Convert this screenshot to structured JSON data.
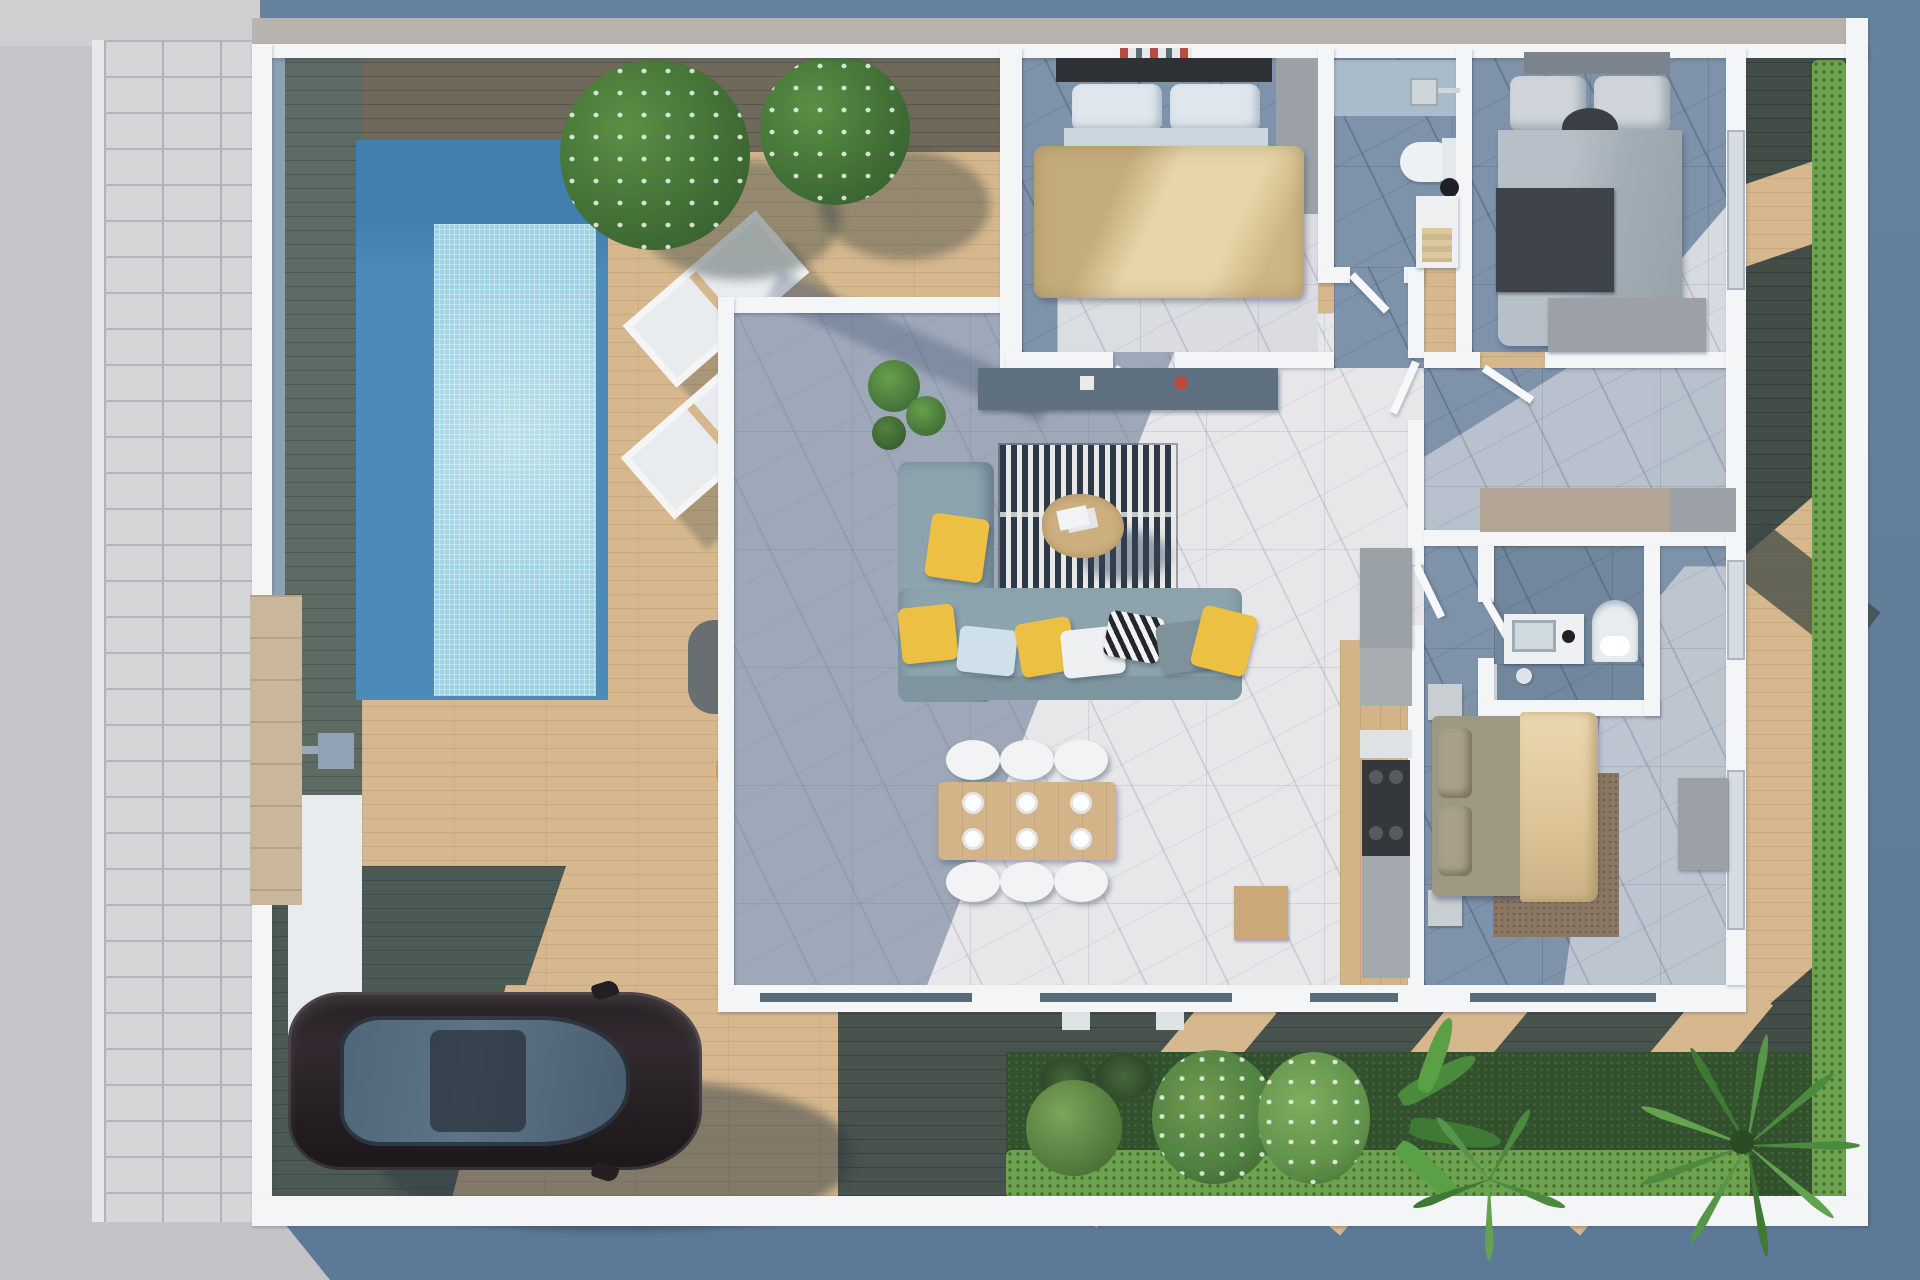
{
  "scene": {
    "title": "Top-view 3D render of a single-storey villa floor plan with pool terrace, garden and parked car",
    "view": "top-down axonometric render",
    "no_visible_text": true
  },
  "palette": {
    "bg_blue": "#66829e",
    "bg_blue_dark": "#5c7a98",
    "bg_gray": "#c6c6ca",
    "paver": "#d6d6d8",
    "wall_white": "#f3f5f7",
    "top_band": "#b9b3ad",
    "deck_sun": "#d7b88e",
    "deck_shade": "#5d6b64",
    "deck_dark": "#49534e",
    "pool_deep": "#4d8ab8",
    "pool_deep_dark": "#437fad",
    "pool_tile": "#9fd3e3",
    "marble_sun": "#e7e7e9",
    "marble_shade": "#7e93aa",
    "grass": "#33502e",
    "hedge": "#6da24f",
    "wood": "#d3b489",
    "sofa": "#8da4ae",
    "accent_yellow": "#ecc043",
    "rug_dark": "#2c3947",
    "car_body": "#2b2429",
    "car_glass": "#5d7487",
    "counter_gray": "#9aa1a7",
    "cooktop": "#34383c",
    "bed_gold": "#d4bd8b",
    "bed_gray": "#aab3bb",
    "bed_beige": "#e3cda6",
    "dresser_gray": "#9ba1a7",
    "closet_beige": "#b3a596",
    "wicker": "#c89e66",
    "cushion": "#e2dccd",
    "stone_entry": "#c9b69b",
    "accent_blue_strip": "#8ca1b3"
  },
  "exterior": {
    "walkway": {
      "name": "paver sidewalk strip",
      "side": "left"
    },
    "pool": {
      "name": "rectangular swimming pool",
      "water": "deep blue rim with light mosaic shallow"
    },
    "sun_loungers": {
      "count": 2,
      "color": "white"
    },
    "lounge_set": {
      "table": "dark rounded-square side table",
      "chairs": 3,
      "style": "round wicker with beige cushion"
    },
    "trees": {
      "count": 2,
      "type": "flowering patio trees"
    },
    "car": {
      "type": "sedan, top view",
      "color": "dark brown-black",
      "position": "parked on bottom-left deck"
    },
    "entrance": {
      "gate": "small grey gate",
      "pillar": "beige stone section",
      "path": "white entry pad"
    },
    "garden": {
      "position": "bottom-right",
      "plants": [
        "round shrub",
        "spiky grasses",
        "white flowering bushes",
        "banana plant",
        "fan palms"
      ],
      "hedges": [
        "bottom hedge row",
        "right boundary hedge"
      ]
    },
    "side_yard": {
      "position": "right",
      "surface": "shaded wood deck with sunlit patches"
    }
  },
  "rooms": [
    {
      "name": "pool terrace deck",
      "furniture": [
        "swimming pool",
        "2 sun loungers",
        "3 wicker chairs",
        "side table",
        "bushes"
      ]
    },
    {
      "name": "master bedroom",
      "furniture": [
        "double bed with gold duvet",
        "dark headboard",
        "white pillows",
        "grey wardrobe",
        "shelf decor"
      ]
    },
    {
      "name": "family bathroom",
      "furniture": [
        "shower head",
        "toilet",
        "black basin",
        "vanity with towels"
      ]
    },
    {
      "name": "bedroom two",
      "furniture": [
        "double bed grey duvet",
        "dark throw blanket",
        "headboard shelf",
        "grey dresser",
        "window"
      ]
    },
    {
      "name": "hallway",
      "furniture": [
        "door leaves",
        "corridor"
      ]
    },
    {
      "name": "living dining room",
      "furniture": [
        "L-shaped sofa",
        "yellow pillows",
        "chevron pillow",
        "striped rug",
        "round coffee table",
        "TV console",
        "dining table",
        "6 white chairs",
        "place settings",
        "indoor plants"
      ]
    },
    {
      "name": "kitchen",
      "furniture": [
        "tall cabinets",
        "cooktop",
        "counter run",
        "wood sideboard"
      ]
    },
    {
      "name": "ensuite bathroom",
      "furniture": [
        "vanity with mirror",
        "arched toilet niche",
        "shower glass",
        "floor lamp"
      ]
    },
    {
      "name": "bedroom three",
      "furniture": [
        "double bed beige duvet",
        "olive pillows",
        "2 nightstands",
        "brown rug",
        "grey desk wardrobe",
        "window"
      ]
    },
    {
      "name": "rear garden",
      "furniture": [
        "lawn",
        "hedge row",
        "shrubs",
        "palms"
      ]
    }
  ]
}
